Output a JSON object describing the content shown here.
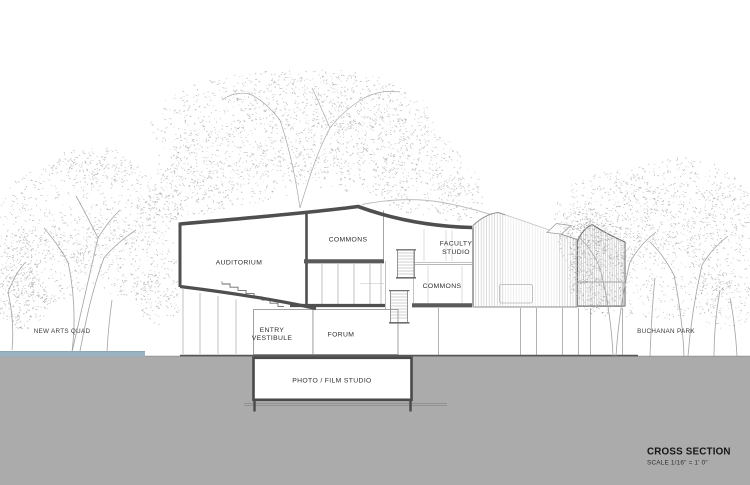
{
  "drawing": {
    "title": "CROSS SECTION",
    "scale_note": "SCALE 1/16\" = 1' 0\"",
    "site": {
      "left_label": "NEW ARTS QUAD",
      "right_label": "BUCHANAN PARK"
    },
    "rooms": {
      "auditorium": "AUDITORIUM",
      "commons_upper": "COMMONS",
      "faculty_studio": {
        "line1": "FACULTY",
        "line2": "STUDIO"
      },
      "commons_lower": "COMMONS",
      "entry_vestibule": {
        "line1": "ENTRY",
        "line2": "VESTIBULE"
      },
      "forum": "FORUM",
      "photo_film_studio": "PHOTO / FILM STUDIO"
    },
    "colors": {
      "paper": "#ffffff",
      "ground": "#ababab",
      "water": "#9ab2c2",
      "cut_line": "#4f4f4f",
      "thin_line": "#9a9a9a",
      "ink": "#2d2d2d"
    }
  }
}
